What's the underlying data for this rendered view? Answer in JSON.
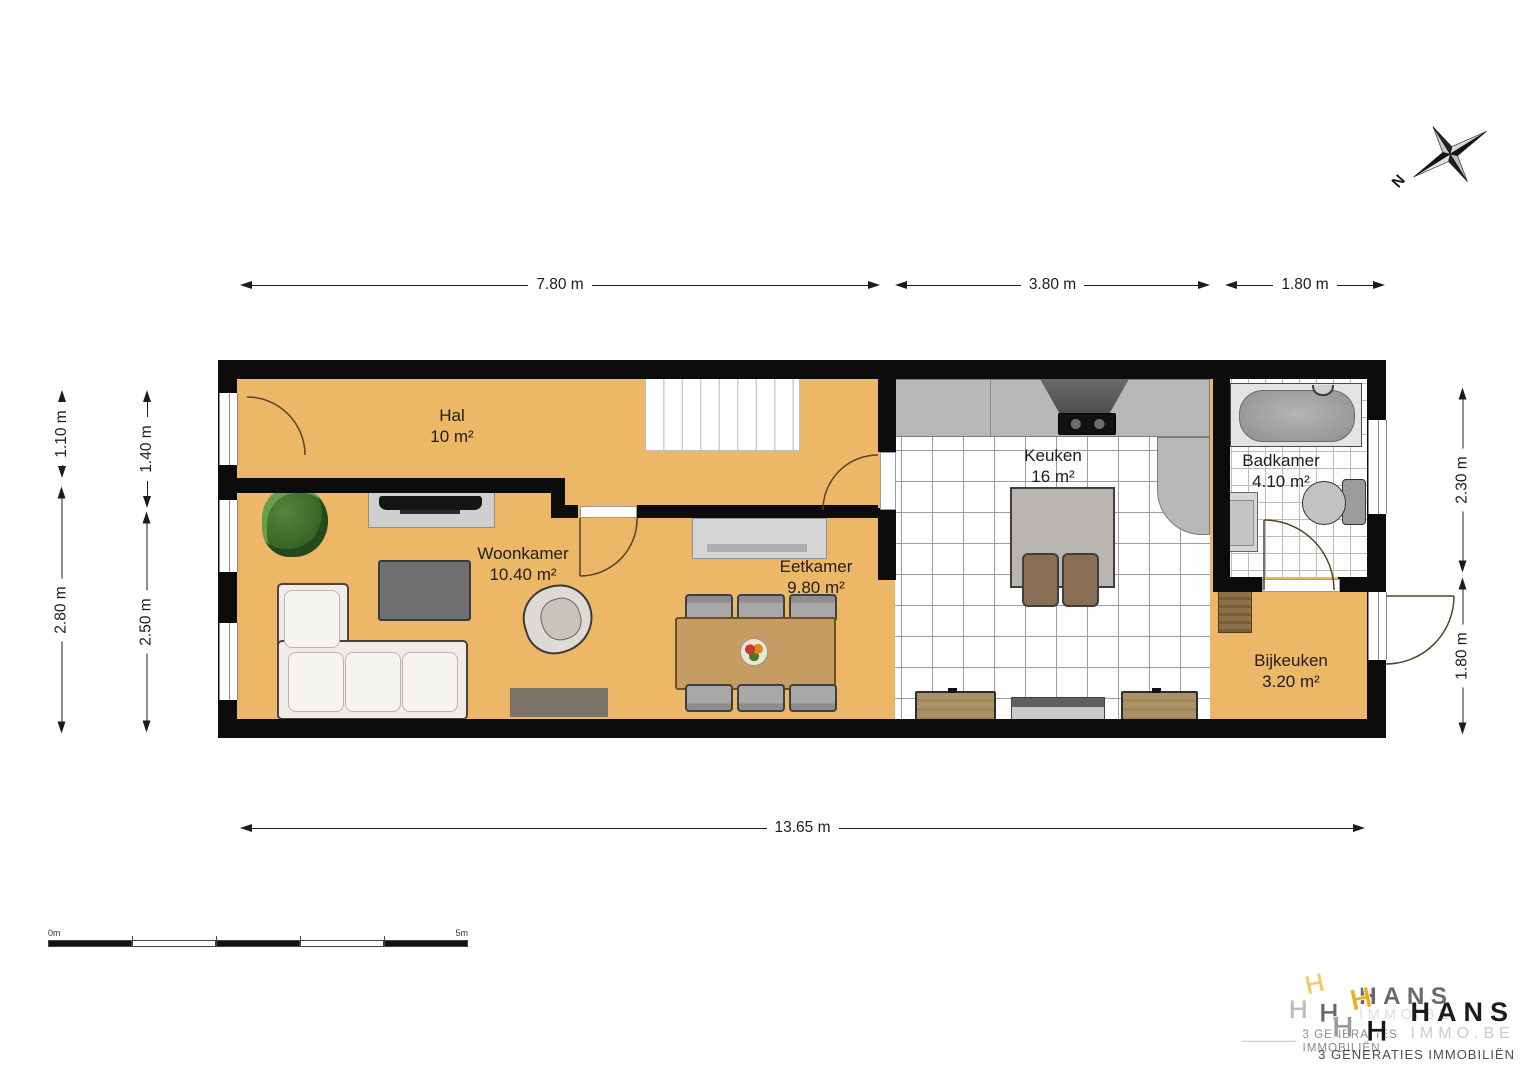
{
  "rooms": [
    {
      "name": "Hal",
      "area": "10 m²"
    },
    {
      "name": "Woonkamer",
      "area": "10.40 m²"
    },
    {
      "name": "Eetkamer",
      "area": "9.80 m²"
    },
    {
      "name": "Keuken",
      "area": "16 m²"
    },
    {
      "name": "Badkamer",
      "area": "4.10 m²"
    },
    {
      "name": "Bijkeuken",
      "area": "3.20 m²"
    }
  ],
  "dimensions": {
    "top": [
      {
        "label": "7.80 m"
      },
      {
        "label": "3.80 m"
      },
      {
        "label": "1.80 m"
      }
    ],
    "bottom": [
      {
        "label": "13.65 m"
      }
    ],
    "left_outer": [
      {
        "label": "1.10 m"
      },
      {
        "label": "2.80 m"
      }
    ],
    "left_inner": [
      {
        "label": "1.40 m"
      },
      {
        "label": "2.50 m"
      }
    ],
    "right": [
      {
        "label": "2.30 m"
      },
      {
        "label": "1.80 m"
      }
    ]
  },
  "scale_bar": {
    "start": "0m",
    "end": "5m"
  },
  "compass": {
    "label": "N"
  },
  "logo": {
    "h": "H",
    "brand": "HANS",
    "domain": "IMMO.BE",
    "tagline": "3 GENERATIES IMMOBILIËN"
  },
  "colors": {
    "floor": "#ECB766",
    "wall": "#0c0c0c",
    "brand_yellow": "#F2AC15"
  }
}
